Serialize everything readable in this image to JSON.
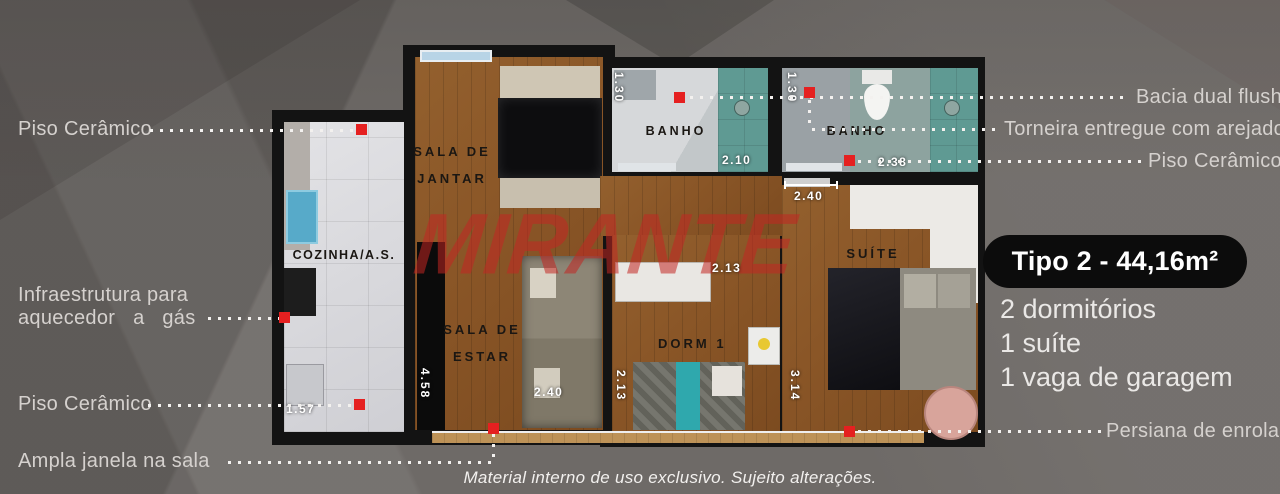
{
  "watermark": "MIRANTE",
  "disclaimer": "Material interno de uso exclusivo. Sujeito alterações.",
  "unit_card": {
    "title": "Tipo 2 - 44,16m²",
    "feature_1": "2 dormitórios",
    "feature_2": "1 suíte",
    "feature_3": "1 vaga de garagem"
  },
  "callouts": {
    "left": {
      "piso_ceramico_top": "Piso Cerâmico",
      "infra_line1": "Infraestrutura para",
      "infra_line2": "aquecedor a gás",
      "piso_ceramico_bottom": "Piso Cerâmico",
      "ampla_janela": "Ampla janela na sala"
    },
    "right": {
      "bacia": "Bacia dual flush",
      "torneira": "Torneira entregue com arejador",
      "piso_ceramico": "Piso Cerâmico",
      "persiana": "Persiana de enrolar"
    }
  },
  "rooms": {
    "sala_jantar_line1": "SALA DE",
    "sala_jantar_line2": "JANTAR",
    "cozinha": "COZINHA/A.S.",
    "banho_1": "BANHO",
    "banho_2": "BANHO",
    "sala_estar_line1": "SALA DE",
    "sala_estar_line2": "ESTAR",
    "dorm_1": "DORM 1",
    "suite": "SUÍTE"
  },
  "dimensions": {
    "banho1_width": "1.30",
    "banho1_depth": "2.10",
    "banho2_width": "1.30",
    "banho2_depth": "2.38",
    "suite_entry": "2.40",
    "dorm1_top": "2.13",
    "dorm1_side": "2.13",
    "sala_estar_bottom": "2.40",
    "sala_estar_side": "4.58",
    "suite_side": "3.14",
    "cozinha_bottom": "1.57"
  },
  "colors": {
    "accent_red": "#e52020",
    "wood_floor": "#8a5627",
    "tile_floor": "#dcdce0",
    "shower_teal": "#5f9a93",
    "wall_black": "#131313",
    "background_gray": "#6e6a67"
  }
}
